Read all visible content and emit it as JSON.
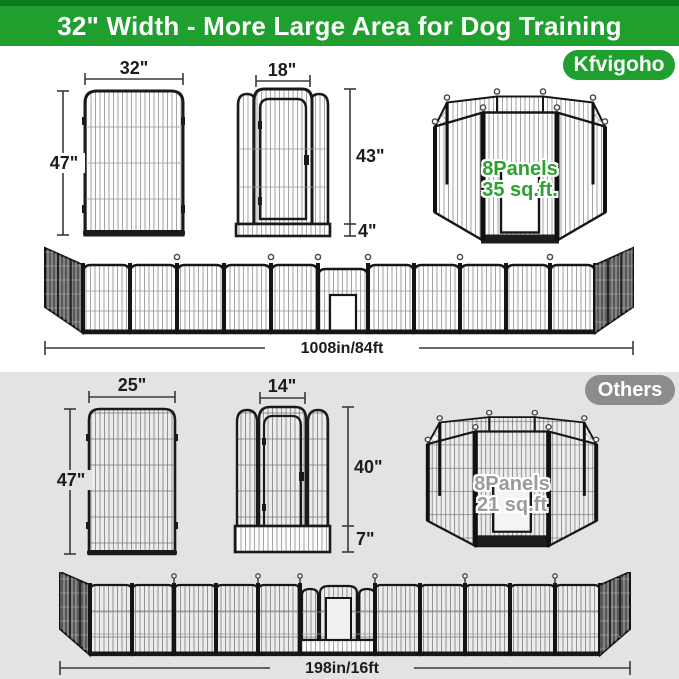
{
  "banner": {
    "title": "32\" Width - More Large Area for Dog Training"
  },
  "brand_section": {
    "badge_label": "Kfvigoho",
    "panel": {
      "width_label": "32\"",
      "height_label": "47\""
    },
    "door_panel": {
      "door_width_label": "18\"",
      "door_height_label": "43\"",
      "bottom_height_label": "4\""
    },
    "pen": {
      "panels_label": "8Panels",
      "area_label": "35 sq.ft."
    },
    "fence": {
      "total_length_label": "1008in/84ft"
    }
  },
  "others_section": {
    "badge_label": "Others",
    "panel": {
      "width_label": "25\"",
      "height_label": "47\""
    },
    "door_panel": {
      "door_width_label": "14\"",
      "door_height_label": "40\"",
      "bottom_height_label": "7\""
    },
    "pen": {
      "panels_label": "8Panels",
      "area_label": "21 sq.ft"
    },
    "fence": {
      "total_length_label": "198in/16ft"
    }
  },
  "colors": {
    "brand_green": "#1f9f2e",
    "banner_top_strip": "#0b7a1c",
    "others_badge_gray": "#8c8c8c",
    "others_background": "#e3e3e3",
    "pen_text_green": "#2aa32d",
    "pen_text_gray": "#9b9b9b"
  }
}
